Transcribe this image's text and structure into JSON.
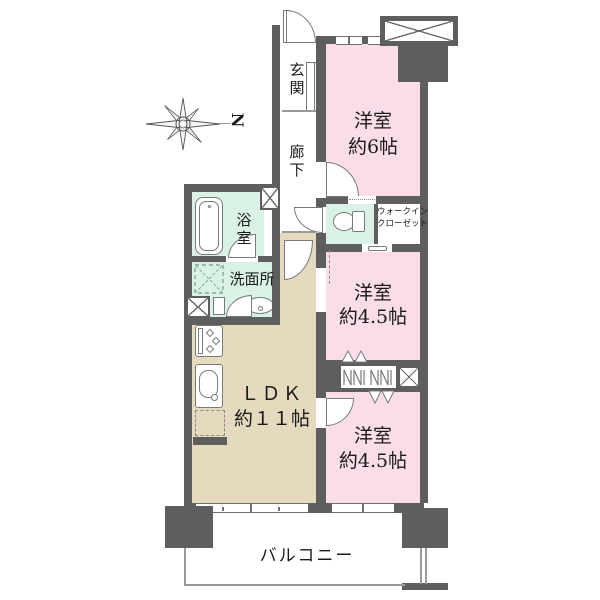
{
  "compass": {
    "north": "N"
  },
  "rooms": {
    "genkan": {
      "label": "玄関"
    },
    "corridor": {
      "label": "廊下"
    },
    "bedroom6": {
      "name": "洋室",
      "size": "約6帖"
    },
    "wic": {
      "line1": "ウォークイン",
      "line2": "クローゼット"
    },
    "bathroom": {
      "label": "浴室"
    },
    "washroom": {
      "label": "洗面所"
    },
    "bedroom45a": {
      "name": "洋室",
      "size": "約4.5帖"
    },
    "bedroom45b": {
      "name": "洋室",
      "size": "約4.5帖"
    },
    "ldk": {
      "name": "ＬＤＫ",
      "size": "約１１帖"
    },
    "balcony": {
      "label": "バルコニー"
    }
  },
  "colors": {
    "wall": "#5e5e5e",
    "bedroom_pink": "#fadde6",
    "wet_area_mint": "#d9f2e5",
    "ldk_beige": "#e6dabe",
    "outline_gray": "#7a7a7a",
    "text": "#1b1b1b"
  }
}
